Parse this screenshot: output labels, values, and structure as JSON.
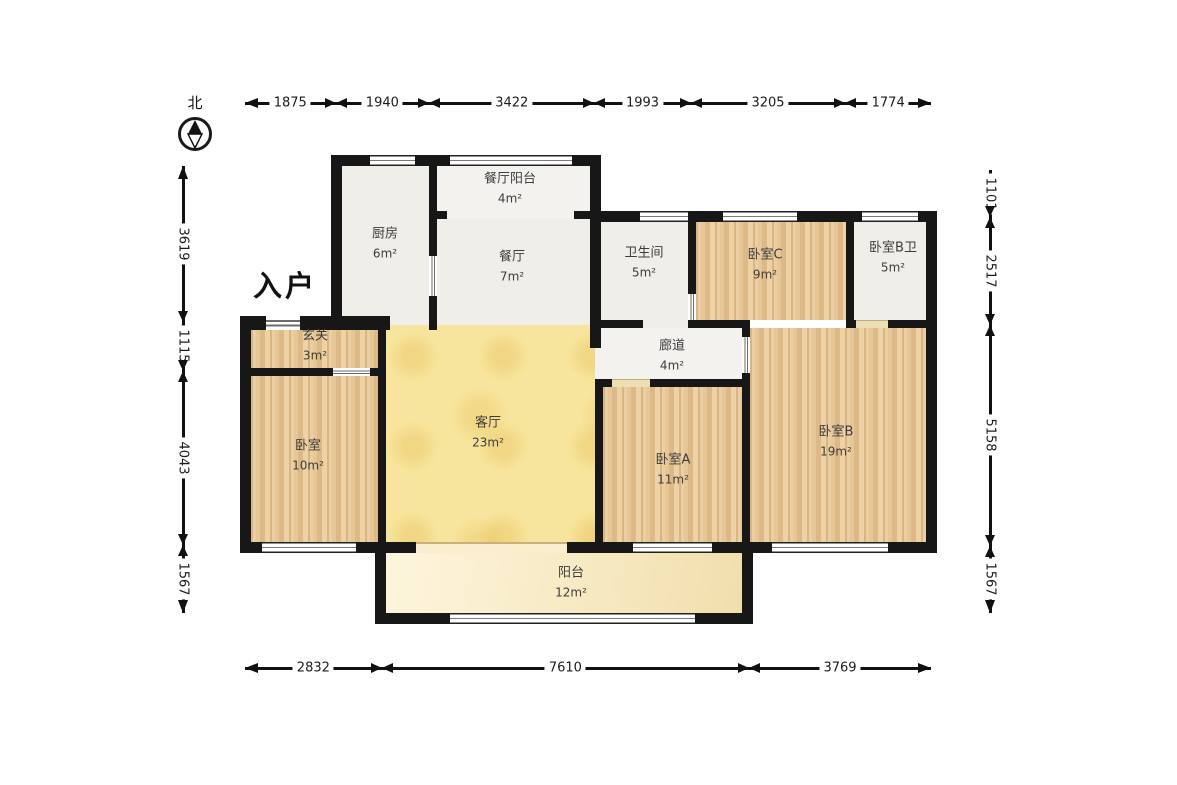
{
  "compass": {
    "label": "北"
  },
  "entrance_label": "入户",
  "rooms": [
    {
      "id": "kitchen",
      "name": "厨房",
      "area": "6m²"
    },
    {
      "id": "dining-balcony",
      "name": "餐厅阳台",
      "area": "4m²"
    },
    {
      "id": "dining",
      "name": "餐厅",
      "area": "7m²"
    },
    {
      "id": "bathroom",
      "name": "卫生间",
      "area": "5m²"
    },
    {
      "id": "bedroom-c",
      "name": "卧室C",
      "area": "9m²"
    },
    {
      "id": "bedroom-b-bath",
      "name": "卧室B卫",
      "area": "5m²"
    },
    {
      "id": "foyer",
      "name": "玄关",
      "area": "3m²"
    },
    {
      "id": "corridor",
      "name": "廊道",
      "area": "4m²"
    },
    {
      "id": "living-room",
      "name": "客厅",
      "area": "23m²"
    },
    {
      "id": "bedroom",
      "name": "卧室",
      "area": "10m²"
    },
    {
      "id": "bedroom-a",
      "name": "卧室A",
      "area": "11m²"
    },
    {
      "id": "bedroom-b",
      "name": "卧室B",
      "area": "19m²"
    },
    {
      "id": "balcony",
      "name": "阳台",
      "area": "12m²"
    }
  ],
  "dimensions_mm": {
    "top": [
      "1875",
      "1940",
      "3422",
      "1993",
      "3205",
      "1774"
    ],
    "bottom": [
      "2832",
      "7610",
      "3769"
    ],
    "left": [
      "3619",
      "1115",
      "4043",
      "1567"
    ],
    "right": [
      "1101",
      "2517",
      "5158",
      "1567"
    ]
  },
  "colors": {
    "wall": "#171717",
    "wood_floor": "#e7c795",
    "living_floor": "#f8e59d",
    "balcony_floor": "#f8ecc8",
    "tile_floor": "#f0eee8"
  }
}
